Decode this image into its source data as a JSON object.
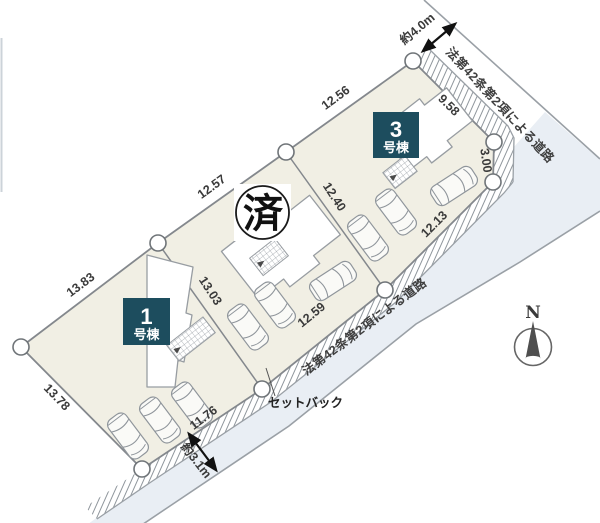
{
  "site": {
    "buildings": {
      "b1": {
        "number": "1",
        "suffix": "号棟"
      },
      "b3": {
        "number": "3",
        "suffix": "号棟"
      }
    },
    "sold_badge": "済",
    "dimensions": {
      "ab": "13.83",
      "bc": "12.57",
      "cd": "12.56",
      "de": "9.58",
      "ef": "3.00",
      "fg": "12.13",
      "gh": "12.59",
      "hi": "11.76",
      "ai": "13.78",
      "bh": "13.03",
      "cg": "12.40"
    },
    "roads": {
      "name": "法第42条第2項による道路",
      "top_width": "約4.0m",
      "bottom_width": "約3.1m"
    },
    "setback_label": "セットバック",
    "compass": {
      "north": "N"
    },
    "colors": {
      "lot_fill": "#f1efe4",
      "road_fill": "#e9eef4",
      "accent_box": "#1d4d5e"
    }
  }
}
